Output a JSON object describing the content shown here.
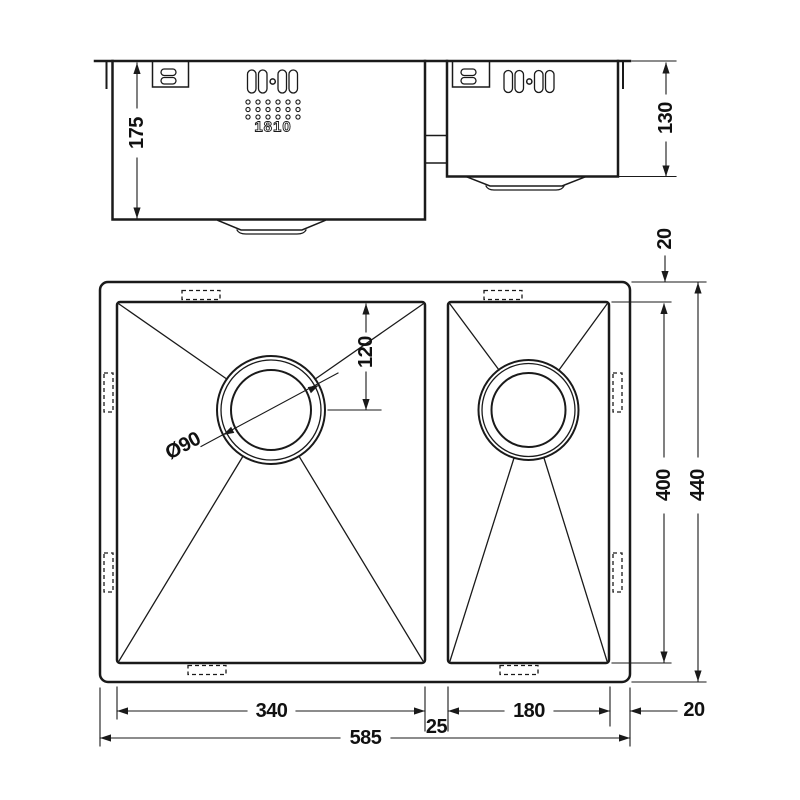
{
  "colors": {
    "line": "#1a1a1a",
    "background": "#ffffff"
  },
  "side_view": {
    "main_bowl_depth": "175",
    "half_bowl_depth": "130",
    "logo": "1810"
  },
  "plan_view": {
    "top_rim": "20",
    "inner_length": "400",
    "overall_length": "440",
    "drain_offset": "120",
    "drain_diameter": "Ø90",
    "main_bowl_width": "340",
    "divider_width": "25",
    "half_bowl_width": "180",
    "right_rim": "20",
    "overall_width": "585"
  }
}
